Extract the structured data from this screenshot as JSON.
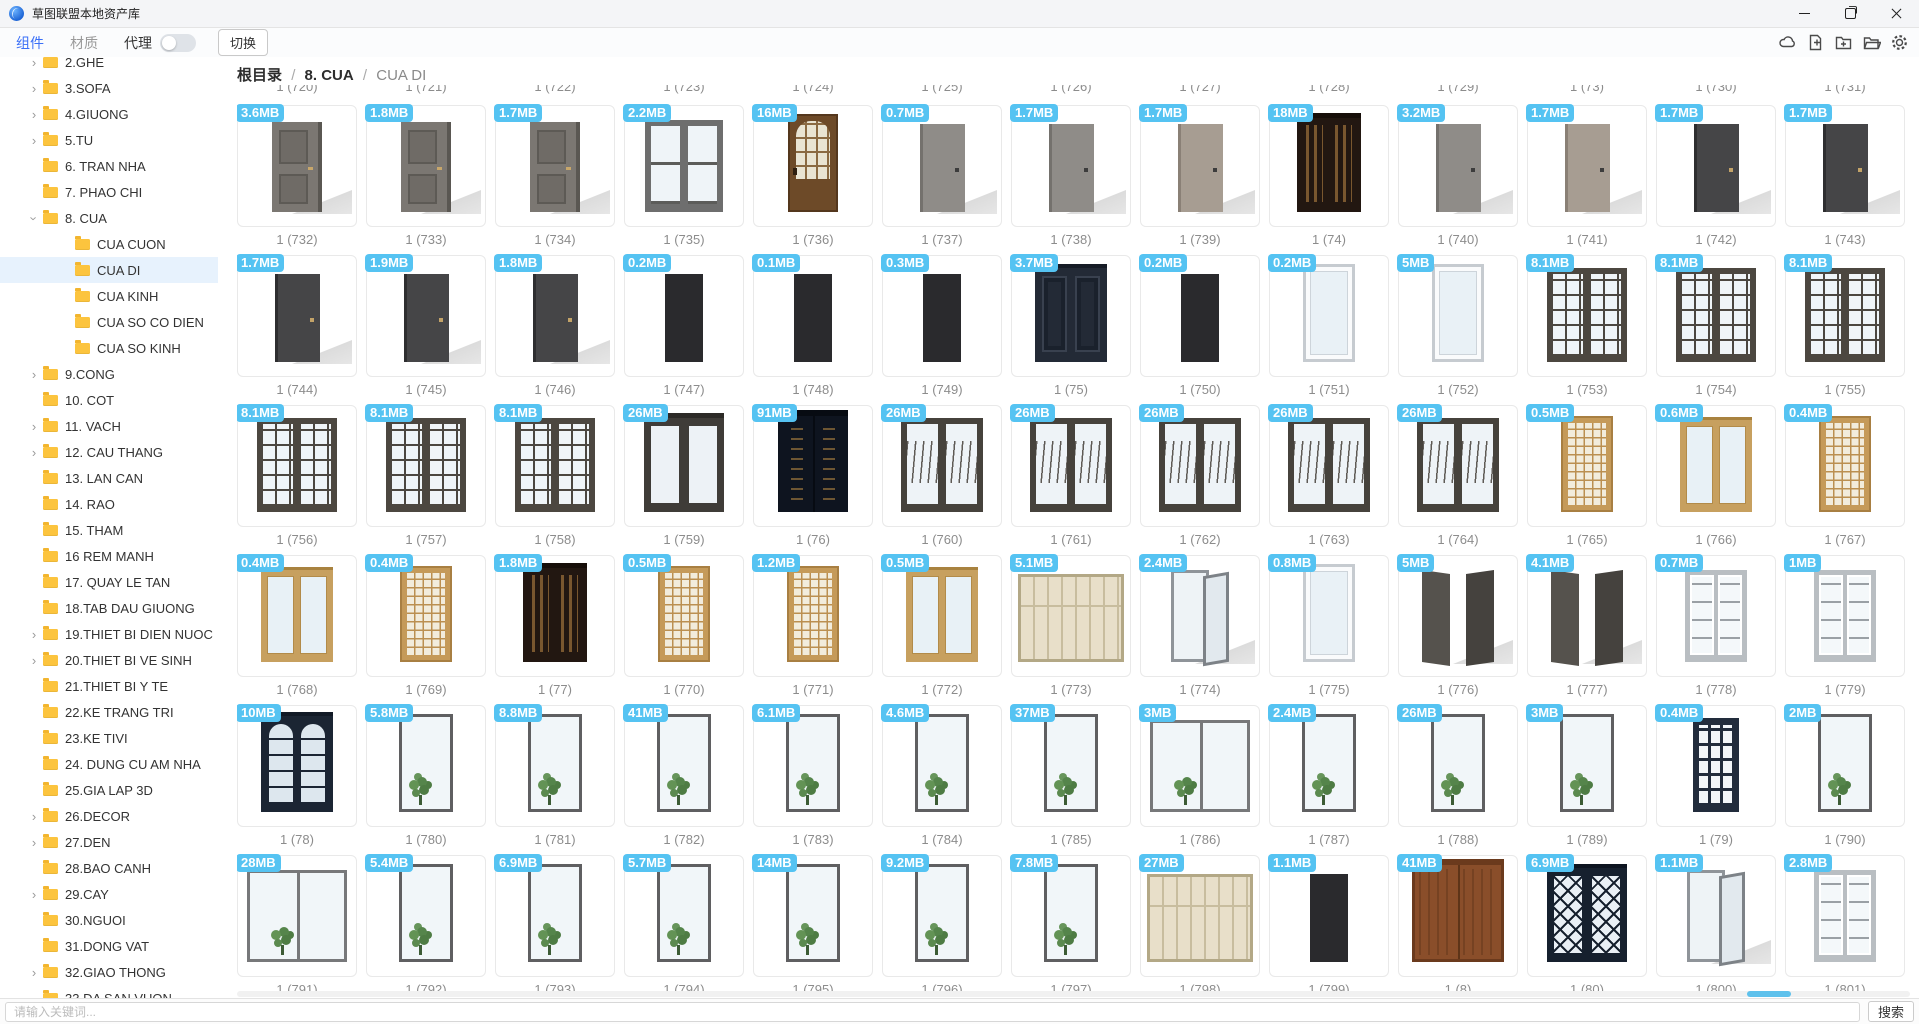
{
  "window": {
    "title": "草图联盟本地资产库",
    "controls": [
      "minimize",
      "maximize",
      "close"
    ]
  },
  "colors": {
    "accent_blue": "#3a6ff7",
    "badge_blue": "#55c3f2",
    "folder_yellow": "#fcc43e",
    "selection_blue": "#e7f2fd",
    "scroll_thumb_blue": "#5ec1ec"
  },
  "toolbar": {
    "tabs": [
      {
        "label": "组件",
        "active": true
      },
      {
        "label": "材质",
        "active": false
      }
    ],
    "proxy_label": "代理",
    "proxy_toggle_state": "off",
    "switch_label": "切换",
    "action_icons": [
      "cloud",
      "new-file",
      "new-folder",
      "open-folder",
      "settings"
    ]
  },
  "breadcrumb": {
    "root": "根目录",
    "separator": "/",
    "parent": "8. CUA",
    "current": "CUA DI"
  },
  "sidebar": {
    "items": [
      {
        "label": "2.GHE",
        "level": 0,
        "chevron": "right"
      },
      {
        "label": "3.SOFA",
        "level": 0,
        "chevron": "right"
      },
      {
        "label": "4.GIUONG",
        "level": 0,
        "chevron": "right"
      },
      {
        "label": "5.TU",
        "level": 0,
        "chevron": "right"
      },
      {
        "label": "6. TRAN NHA",
        "level": 0,
        "chevron": "none"
      },
      {
        "label": "7. PHAO CHI",
        "level": 0,
        "chevron": "none"
      },
      {
        "label": "8. CUA",
        "level": 0,
        "chevron": "down"
      },
      {
        "label": "CUA CUON",
        "level": 1,
        "chevron": "none"
      },
      {
        "label": "CUA DI",
        "level": 1,
        "chevron": "none",
        "selected": true
      },
      {
        "label": "CUA KINH",
        "level": 1,
        "chevron": "none"
      },
      {
        "label": "CUA SO CO DIEN",
        "level": 1,
        "chevron": "none"
      },
      {
        "label": "CUA SO KINH",
        "level": 1,
        "chevron": "none"
      },
      {
        "label": "9.CONG",
        "level": 0,
        "chevron": "right"
      },
      {
        "label": "10. COT",
        "level": 0,
        "chevron": "none"
      },
      {
        "label": "11. VACH",
        "level": 0,
        "chevron": "right"
      },
      {
        "label": "12. CAU THANG",
        "level": 0,
        "chevron": "right"
      },
      {
        "label": "13. LAN CAN",
        "level": 0,
        "chevron": "none"
      },
      {
        "label": "14. RAO",
        "level": 0,
        "chevron": "none"
      },
      {
        "label": "15. THAM",
        "level": 0,
        "chevron": "none"
      },
      {
        "label": "16 REM MANH",
        "level": 0,
        "chevron": "none"
      },
      {
        "label": "17. QUAY LE TAN",
        "level": 0,
        "chevron": "none"
      },
      {
        "label": "18.TAB DAU GIUONG",
        "level": 0,
        "chevron": "none"
      },
      {
        "label": "19.THIET BI DIEN NUOC",
        "level": 0,
        "chevron": "right"
      },
      {
        "label": "20.THIET BI VE SINH",
        "level": 0,
        "chevron": "right"
      },
      {
        "label": "21.THIET BI Y TE",
        "level": 0,
        "chevron": "none"
      },
      {
        "label": "22.KE TRANG TRI",
        "level": 0,
        "chevron": "none"
      },
      {
        "label": "23.KE TIVI",
        "level": 0,
        "chevron": "none"
      },
      {
        "label": "24. DUNG CU AM NHA",
        "level": 0,
        "chevron": "none"
      },
      {
        "label": "25.GIA LAP 3D",
        "level": 0,
        "chevron": "none"
      },
      {
        "label": "26.DECOR",
        "level": 0,
        "chevron": "right"
      },
      {
        "label": "27.DEN",
        "level": 0,
        "chevron": "right"
      },
      {
        "label": "28.BAO CANH",
        "level": 0,
        "chevron": "none"
      },
      {
        "label": "29.CAY",
        "level": 0,
        "chevron": "right"
      },
      {
        "label": "30.NGUOI",
        "level": 0,
        "chevron": "none"
      },
      {
        "label": "31.DONG VAT",
        "level": 0,
        "chevron": "none"
      },
      {
        "label": "32.GIAO THONG",
        "level": 0,
        "chevron": "right"
      },
      {
        "label": "33.DA SAN VUON",
        "level": 0,
        "chevron": "none"
      }
    ]
  },
  "search": {
    "placeholder": "请输入关键词...",
    "button_label": "搜索"
  },
  "grid": {
    "partial_top_labels": [
      "1 (720)",
      "1 (721)",
      "1 (722)",
      "1 (723)",
      "1 (724)",
      "1 (725)",
      "1 (726)",
      "1 (727)",
      "1 (728)",
      "1 (729)",
      "1 (73)",
      "1 (730)",
      "1 (731)"
    ],
    "rows": [
      {
        "items": [
          {
            "name": "1 (732)",
            "size": "3.6MB",
            "variant": "panel-gray"
          },
          {
            "name": "1 (733)",
            "size": "1.8MB",
            "variant": "panel-gray"
          },
          {
            "name": "1 (734)",
            "size": "1.7MB",
            "variant": "panel-gray"
          },
          {
            "name": "1 (735)",
            "size": "2.2MB",
            "variant": "double-glass-gray"
          },
          {
            "name": "1 (736)",
            "size": "16MB",
            "variant": "brown-arch"
          },
          {
            "name": "1 (737)",
            "size": "0.7MB",
            "variant": "slab-gray"
          },
          {
            "name": "1 (738)",
            "size": "1.7MB",
            "variant": "slab-gray"
          },
          {
            "name": "1 (739)",
            "size": "1.7MB",
            "variant": "slab-taupe"
          },
          {
            "name": "1 (74)",
            "size": "18MB",
            "variant": "dark-ornate"
          },
          {
            "name": "1 (740)",
            "size": "3.2MB",
            "variant": "slab-gray"
          },
          {
            "name": "1 (741)",
            "size": "1.7MB",
            "variant": "slab-taupe"
          },
          {
            "name": "1 (742)",
            "size": "1.7MB",
            "variant": "slab-dark"
          },
          {
            "name": "1 (743)",
            "size": "1.7MB",
            "variant": "slab-dark"
          }
        ]
      },
      {
        "items": [
          {
            "name": "1 (744)",
            "size": "1.7MB",
            "variant": "slab-dark"
          },
          {
            "name": "1 (745)",
            "size": "1.9MB",
            "variant": "slab-dark"
          },
          {
            "name": "1 (746)",
            "size": "1.8MB",
            "variant": "slab-dark"
          },
          {
            "name": "1 (747)",
            "size": "0.2MB",
            "variant": "slab-black"
          },
          {
            "name": "1 (748)",
            "size": "0.1MB",
            "variant": "slab-black"
          },
          {
            "name": "1 (749)",
            "size": "0.3MB",
            "variant": "slab-black"
          },
          {
            "name": "1 (75)",
            "size": "3.7MB",
            "variant": "navy-double"
          },
          {
            "name": "1 (750)",
            "size": "0.2MB",
            "variant": "slab-black"
          },
          {
            "name": "1 (751)",
            "size": "0.2MB",
            "variant": "white-glass"
          },
          {
            "name": "1 (752)",
            "size": "5MB",
            "variant": "white-glass"
          },
          {
            "name": "1 (753)",
            "size": "8.1MB",
            "variant": "grid-glass-dark"
          },
          {
            "name": "1 (754)",
            "size": "8.1MB",
            "variant": "grid-glass-dark"
          },
          {
            "name": "1 (755)",
            "size": "8.1MB",
            "variant": "grid-glass-dark"
          }
        ]
      },
      {
        "items": [
          {
            "name": "1 (756)",
            "size": "8.1MB",
            "variant": "grid-glass-dark"
          },
          {
            "name": "1 (757)",
            "size": "8.1MB",
            "variant": "grid-glass-dark"
          },
          {
            "name": "1 (758)",
            "size": "8.1MB",
            "variant": "grid-glass-dark"
          },
          {
            "name": "1 (759)",
            "size": "26MB",
            "variant": "double-glass-dark"
          },
          {
            "name": "1 (76)",
            "size": "91MB",
            "variant": "navy-ornate"
          },
          {
            "name": "1 (760)",
            "size": "26MB",
            "variant": "wave-glass"
          },
          {
            "name": "1 (761)",
            "size": "26MB",
            "variant": "wave-glass"
          },
          {
            "name": "1 (762)",
            "size": "26MB",
            "variant": "wave-glass"
          },
          {
            "name": "1 (763)",
            "size": "26MB",
            "variant": "wave-glass"
          },
          {
            "name": "1 (764)",
            "size": "26MB",
            "variant": "wave-glass"
          },
          {
            "name": "1 (765)",
            "size": "0.5MB",
            "variant": "gold-lattice"
          },
          {
            "name": "1 (766)",
            "size": "0.6MB",
            "variant": "gold-glass"
          },
          {
            "name": "1 (767)",
            "size": "0.4MB",
            "variant": "gold-lattice"
          }
        ]
      },
      {
        "items": [
          {
            "name": "1 (768)",
            "size": "0.4MB",
            "variant": "gold-glass"
          },
          {
            "name": "1 (769)",
            "size": "0.4MB",
            "variant": "gold-lattice"
          },
          {
            "name": "1 (77)",
            "size": "1.8MB",
            "variant": "dark-ornate"
          },
          {
            "name": "1 (770)",
            "size": "0.5MB",
            "variant": "gold-lattice"
          },
          {
            "name": "1 (771)",
            "size": "1.2MB",
            "variant": "gold-lattice"
          },
          {
            "name": "1 (772)",
            "size": "0.5MB",
            "variant": "gold-glass"
          },
          {
            "name": "1 (773)",
            "size": "5.1MB",
            "variant": "shoji"
          },
          {
            "name": "1 (774)",
            "size": "2.4MB",
            "variant": "open-glass"
          },
          {
            "name": "1 (775)",
            "size": "0.8MB",
            "variant": "white-glass"
          },
          {
            "name": "1 (776)",
            "size": "5MB",
            "variant": "double-open"
          },
          {
            "name": "1 (777)",
            "size": "4.1MB",
            "variant": "double-open"
          },
          {
            "name": "1 (778)",
            "size": "0.7MB",
            "variant": "grid-glass-light"
          },
          {
            "name": "1 (779)",
            "size": "1MB",
            "variant": "grid-glass-light"
          }
        ]
      },
      {
        "items": [
          {
            "name": "1 (78)",
            "size": "10MB",
            "variant": "navy-arch"
          },
          {
            "name": "1 (780)",
            "size": "5.8MB",
            "variant": "glass-plant"
          },
          {
            "name": "1 (781)",
            "size": "8.8MB",
            "variant": "glass-plant"
          },
          {
            "name": "1 (782)",
            "size": "41MB",
            "variant": "glass-plant"
          },
          {
            "name": "1 (783)",
            "size": "6.1MB",
            "variant": "glass-plant"
          },
          {
            "name": "1 (784)",
            "size": "4.6MB",
            "variant": "glass-plant"
          },
          {
            "name": "1 (785)",
            "size": "37MB",
            "variant": "glass-plant"
          },
          {
            "name": "1 (786)",
            "size": "3MB",
            "variant": "glass-plant-wide"
          },
          {
            "name": "1 (787)",
            "size": "2.4MB",
            "variant": "glass-plant"
          },
          {
            "name": "1 (788)",
            "size": "26MB",
            "variant": "glass-plant"
          },
          {
            "name": "1 (789)",
            "size": "3MB",
            "variant": "glass-plant"
          },
          {
            "name": "1 (79)",
            "size": "0.4MB",
            "variant": "navy-grid"
          },
          {
            "name": "1 (790)",
            "size": "2MB",
            "variant": "glass-plant"
          }
        ]
      },
      {
        "items": [
          {
            "name": "1 (791)",
            "size": "28MB",
            "variant": "glass-plant-wide"
          },
          {
            "name": "1 (792)",
            "size": "5.4MB",
            "variant": "glass-plant"
          },
          {
            "name": "1 (793)",
            "size": "6.9MB",
            "variant": "glass-plant"
          },
          {
            "name": "1 (794)",
            "size": "5.7MB",
            "variant": "glass-plant"
          },
          {
            "name": "1 (795)",
            "size": "14MB",
            "variant": "glass-plant"
          },
          {
            "name": "1 (796)",
            "size": "9.2MB",
            "variant": "glass-plant"
          },
          {
            "name": "1 (797)",
            "size": "7.8MB",
            "variant": "glass-plant"
          },
          {
            "name": "1 (798)",
            "size": "27MB",
            "variant": "shoji"
          },
          {
            "name": "1 (799)",
            "size": "1.1MB",
            "variant": "slab-black"
          },
          {
            "name": "1 (8)",
            "size": "41MB",
            "variant": "brown-double"
          },
          {
            "name": "1 (80)",
            "size": "6.9MB",
            "variant": "navy-x"
          },
          {
            "name": "1 (800)",
            "size": "1.1MB",
            "variant": "open-glass"
          },
          {
            "name": "1 (801)",
            "size": "2.8MB",
            "variant": "grid-glass-light"
          }
        ]
      }
    ],
    "partial_bottom_row_cards": 13
  }
}
